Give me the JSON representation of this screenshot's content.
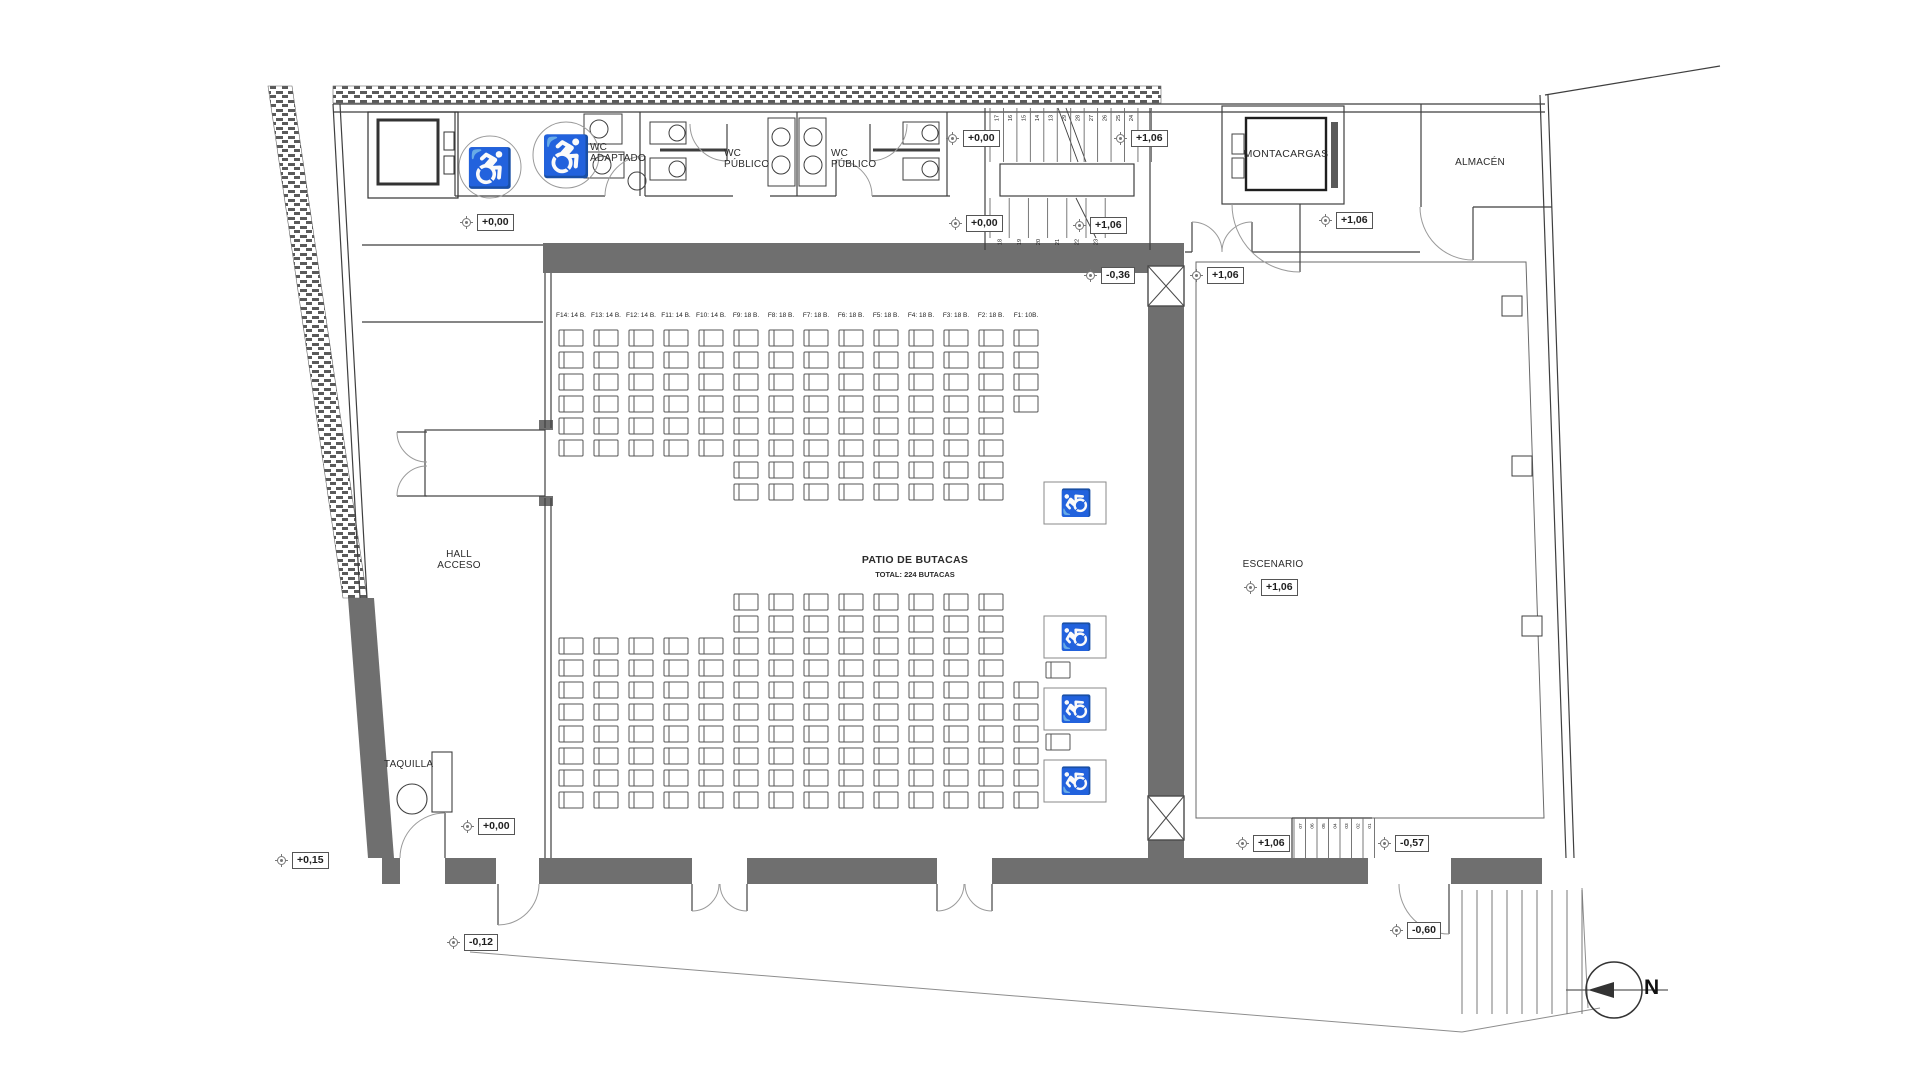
{
  "colors": {
    "wall_fill": "#6f6f6f",
    "line": "#3f3f3f",
    "door_arc": "#9a9a9a",
    "text": "#2b2b2b"
  },
  "labels": {
    "wc_adaptado": "WC\nADAPTADO",
    "wc_publico_1": "WC\nPÚBLICO",
    "wc_publico_2": "WC\nPÚBLICO",
    "montacargas": "MONTACARGAS",
    "almacen": "ALMACÉN",
    "hall_acceso": "HALL\nACCESO",
    "taquilla": "TAQUILLA",
    "patio_title": "PATIO DE BUTACAS",
    "patio_subtitle": "TOTAL: 224 BUTACAS",
    "escenario": "ESCENARIO",
    "north": "N"
  },
  "markers": {
    "corridor_left": "+0,00",
    "stair_top_left": "+0,00",
    "stair_top_right": "+1,06",
    "stair_bottom_left": "+0,00",
    "stair_bottom_right": "+1,06",
    "montacargas_corridor": "+1,06",
    "auditorium_floor": "-0,36",
    "stage_side_top": "+1,06",
    "stage_center": "+1,06",
    "hall_floor": "+0,00",
    "exterior_left": "+0,15",
    "exterior_door_left": "-0,12",
    "stage_stair_left": "+1,06",
    "stage_stair_right": "-0,57",
    "exterior_door_right": "-0,60"
  },
  "seating": {
    "total_butacas": 224,
    "wheelchair_spaces": 4,
    "rows": [
      {
        "id": "F14",
        "label": "F14: 14 B.",
        "seats": 14
      },
      {
        "id": "F13",
        "label": "F13: 14 B.",
        "seats": 14
      },
      {
        "id": "F12",
        "label": "F12: 14 B.",
        "seats": 14
      },
      {
        "id": "F11",
        "label": "F11: 14 B.",
        "seats": 14
      },
      {
        "id": "F10",
        "label": "F10: 14 B.",
        "seats": 14
      },
      {
        "id": "F9",
        "label": "F9: 18 B.",
        "seats": 18
      },
      {
        "id": "F8",
        "label": "F8: 18 B.",
        "seats": 18
      },
      {
        "id": "F7",
        "label": "F7: 18 B.",
        "seats": 18
      },
      {
        "id": "F6",
        "label": "F6: 18 B.",
        "seats": 18
      },
      {
        "id": "F5",
        "label": "F5: 18 B.",
        "seats": 18
      },
      {
        "id": "F4",
        "label": "F4: 18 B.",
        "seats": 18
      },
      {
        "id": "F3",
        "label": "F3: 18 B.",
        "seats": 18
      },
      {
        "id": "F2",
        "label": "F2: 18 B.",
        "seats": 18
      },
      {
        "id": "F1",
        "label": "F1: 10B.",
        "seats": 10
      }
    ]
  },
  "stairs": {
    "main_upper": [
      "17",
      "16",
      "15",
      "14",
      "13",
      "29",
      "28",
      "27",
      "26",
      "25",
      "24"
    ],
    "main_lower": [
      "18",
      "19",
      "20",
      "21",
      "22",
      "23"
    ],
    "stage": [
      "07",
      "06",
      "05",
      "04",
      "03",
      "02",
      "01"
    ]
  }
}
